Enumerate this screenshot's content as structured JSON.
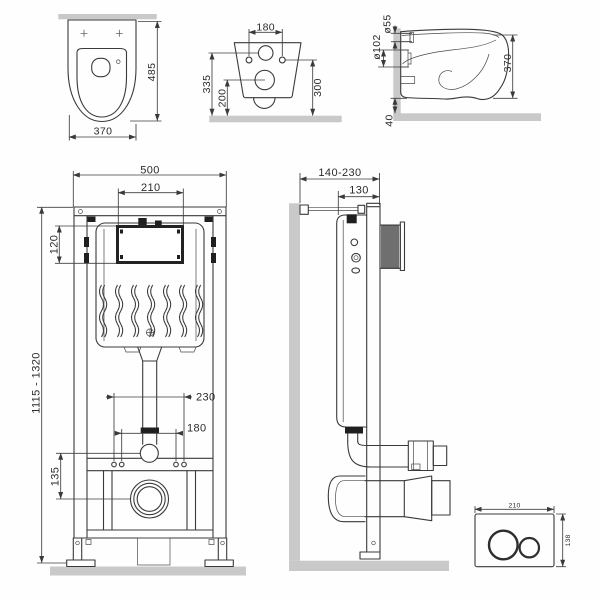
{
  "drawing": {
    "colors": {
      "line": "#3a3a3a",
      "wall_fill": "#c9c9c9",
      "background": "#ffffff",
      "dark_fill": "#1f1f1f"
    },
    "views": {
      "toilet_top": {
        "height": "485",
        "width": "370"
      },
      "toilet_back": {
        "hole_spacing": "180",
        "inlet_to_wall": "335",
        "outlet_to_wall": "200",
        "holes_to_wall": "300"
      },
      "toilet_side": {
        "inlet_diameter": "ø55",
        "outlet_diameter": "ø102",
        "height": "370",
        "floor_gap": "40"
      },
      "frame_front": {
        "width": "500",
        "opening_width": "210",
        "opening_height": "120",
        "height_range": "1115 - 1320",
        "fixing_spacing_outer": "230",
        "fixing_spacing_inner": "180",
        "outlet_drop": "135"
      },
      "frame_side": {
        "wall_distance_range": "140-230",
        "frame_depth": "130"
      },
      "flush_plate": {
        "width": "210",
        "height": "138"
      }
    }
  }
}
